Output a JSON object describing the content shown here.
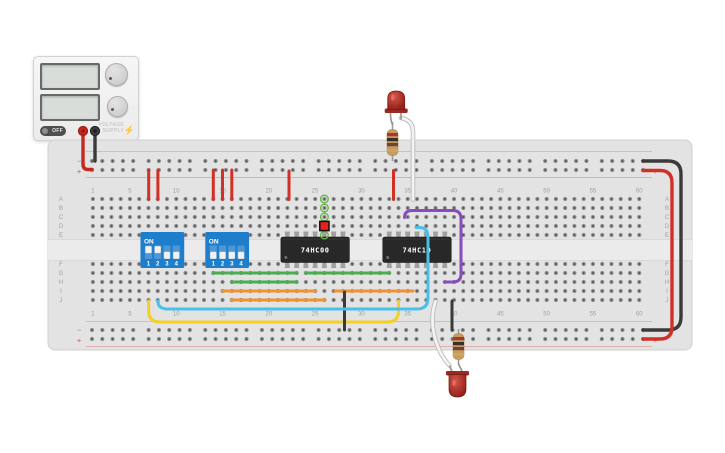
{
  "power_supply": {
    "off_label": "OFF",
    "brand_line1": "VOLTAGE",
    "brand_line2": "SUPPLY",
    "bolt_icon": "⚡",
    "terminals": [
      {
        "name": "terminal-positive",
        "cx": 83,
        "cy": 131,
        "color": "#c4281e",
        "ring": "#8f1b14"
      },
      {
        "name": "terminal-negative",
        "cx": 95,
        "cy": 131,
        "color": "#3c3c3c",
        "ring": "#1e1e1e"
      }
    ]
  },
  "breadboard": {
    "columns": 60,
    "column_labels": [
      "1",
      "5",
      "10",
      "15",
      "20",
      "25",
      "30",
      "35",
      "40",
      "45",
      "50",
      "55",
      "60"
    ],
    "row_labels_upper": [
      "A",
      "B",
      "C",
      "D",
      "E"
    ],
    "row_labels_lower": [
      "F",
      "G",
      "H",
      "I",
      "J"
    ],
    "rail_minus": "−",
    "rail_plus": "+",
    "colors": {
      "body": "#e3e3e3",
      "edge": "#cfcfcf",
      "hole": "#8f8f8f",
      "hole_core": "#484848",
      "label": "#a0a0a0",
      "blue_line": "#a9bfd9",
      "red_line": "#dba4a0"
    }
  },
  "dip_switches": [
    {
      "name": "dip-switch-a",
      "label": "ON",
      "pin_labels": [
        "1",
        "2",
        "3",
        "4"
      ],
      "states": [
        "on",
        "on",
        "off",
        "off"
      ],
      "cols": [
        7,
        8,
        9,
        10
      ]
    },
    {
      "name": "dip-switch-b",
      "label": "ON",
      "pin_labels": [
        "1",
        "2",
        "3",
        "4"
      ],
      "states": [
        "off",
        "off",
        "off",
        "off"
      ],
      "cols": [
        14,
        15,
        16,
        17
      ]
    }
  ],
  "ics": [
    {
      "name": "ic-74hc00",
      "label": "74HC00",
      "pin_count": 14,
      "col_start": 22,
      "col_end": 28
    },
    {
      "name": "ic-74hc10",
      "label": "74HC10",
      "pin_count": 14,
      "col_start": 33,
      "col_end": 39
    }
  ],
  "hover_highlight": {
    "column": 26,
    "selected_row": "D",
    "connected_rows": [
      "A",
      "B",
      "C",
      "E"
    ],
    "ring_color": "#63b93c",
    "selected_fill": "#e8211d"
  },
  "leds": [
    {
      "name": "led-top",
      "cx": 396.2,
      "flange_y": 108.5,
      "dir": "up",
      "color_hi": "#d4574a",
      "color_lo": "#8e211a"
    },
    {
      "name": "led-bottom",
      "cx": 457.5,
      "flange_y": 371,
      "dir": "down",
      "color_hi": "#d4574a",
      "color_lo": "#8e211a"
    }
  ],
  "resistors": [
    {
      "name": "resistor-top",
      "x": 392.5,
      "lead_top_y": 122,
      "body_top_y": 129.5
    },
    {
      "name": "resistor-bottom",
      "x": 458.5,
      "lead_top_y": 329,
      "body_top_y": 333.5
    }
  ],
  "resistor_style": {
    "body": "#c89a62",
    "edge": "#b08648",
    "bands": [
      "#ae352b",
      "#35302a",
      "#6e4333",
      "#c9a65c"
    ]
  },
  "wires": [
    {
      "name": "psu-positive-wire",
      "color": "#c4281e",
      "width": 3.4,
      "layer": "under",
      "path": "M83,130 L83,164 Q83,169.5 88,169.5 L92,169.5"
    },
    {
      "name": "psu-negative-wire",
      "color": "#3a3a3a",
      "width": 3.4,
      "layer": "under",
      "path": "M95,130 L95,161"
    },
    {
      "name": "rail-jumper-1",
      "color": "#d03026",
      "width": 3,
      "layer": "under",
      "path": "M148.7,170 L148.7,199.5"
    },
    {
      "name": "rail-jumper-2",
      "color": "#d03026",
      "width": 3,
      "layer": "under",
      "path": "M157.9,170 L157.9,199.5"
    },
    {
      "name": "rail-jumper-3",
      "color": "#d03026",
      "width": 3,
      "layer": "under",
      "path": "M213.3,170 L213.3,199.5"
    },
    {
      "name": "rail-jumper-4",
      "color": "#d03026",
      "width": 3,
      "layer": "under",
      "path": "M222.5,170 L222.5,199.5"
    },
    {
      "name": "rail-jumper-5",
      "color": "#d03026",
      "width": 3,
      "layer": "under",
      "path": "M231.8,170 L231.8,199.5"
    },
    {
      "name": "rail-jumper-6",
      "color": "#d03026",
      "width": 3,
      "layer": "under",
      "path": "M289,171 L289,199.5"
    },
    {
      "name": "led-top-power-wire",
      "color": "#d03026",
      "width": 3,
      "layer": "under",
      "path": "M393.5,170.5 L393.5,199.5"
    },
    {
      "name": "rail-bridge-negative",
      "color": "#3a3a3a",
      "width": 3.4,
      "layer": "under",
      "path": "M643,161 L668,161 Q681,161 681,174 L681,317 Q681,330 668,330 L643,330"
    },
    {
      "name": "rail-bridge-positive",
      "color": "#d03026",
      "width": 3.4,
      "layer": "under",
      "path": "M643,170.5 L660,170.5 Q672,170.5 672,183 L672,327 Q672,339 660,339 L643,339"
    },
    {
      "name": "green-wire-1",
      "color": "#4aae4f",
      "width": 3,
      "layer": "under",
      "path": "M213.3,273 L296.7,273"
    },
    {
      "name": "green-wire-2",
      "color": "#4aae4f",
      "width": 3,
      "layer": "under",
      "path": "M305.9,273 L389.3,273"
    },
    {
      "name": "green-wire-3",
      "color": "#4aae4f",
      "width": 3,
      "layer": "under",
      "path": "M231.8,282 L296.7,282"
    },
    {
      "name": "orange-wire-1",
      "color": "#f2912d",
      "width": 3,
      "layer": "under",
      "path": "M222.5,291 L315.1,291"
    },
    {
      "name": "orange-wire-2",
      "color": "#f2912d",
      "width": 3,
      "layer": "under",
      "path": "M335,291 L413,291"
    },
    {
      "name": "orange-wire-3",
      "color": "#f2912d",
      "width": 3,
      "layer": "under",
      "path": "M231.8,300 L324.5,300"
    },
    {
      "name": "yellow-wire",
      "color": "#f2d025",
      "width": 3,
      "layer": "under",
      "path": "M148.7,301 L148.7,311 Q148.7,322 159.7,322 L387.5,322 Q398.5,322 398.5,311 L398.5,301"
    },
    {
      "name": "mid-ground-wire",
      "color": "#3a3a3a",
      "width": 3,
      "layer": "under",
      "path": "M344.5,292 L344.5,330"
    },
    {
      "name": "bottom-ground-wire",
      "color": "#3a3a3a",
      "width": 3,
      "layer": "under",
      "path": "M452,301 L452,330"
    },
    {
      "name": "cyan-wire",
      "color": "#49c0e8",
      "width": 3,
      "layer": "over",
      "path": "M157.9,301 Q157.9,309 168,309 L417,309 Q428,309 428,298 L428,237 Q428,227.5 419.5,227.5 L416,227.5"
    },
    {
      "name": "purple-wire",
      "color": "#8a4bbf",
      "width": 3,
      "layer": "over",
      "path": "M404.5,217.5 Q404.5,210.5 412.5,210.5 L453,210.5 Q461,210.5 461,219 L461,274 Q461,282 453,282 L444.8,282"
    },
    {
      "name": "led-top-signal-wire",
      "color": "#f3f3f3",
      "width": 2.8,
      "outline": true,
      "layer": "over",
      "path": "M401,118 Q413,120 413,132 L413,199.5"
    },
    {
      "name": "led-bottom-signal-wire",
      "color": "#f3f3f3",
      "width": 2.8,
      "outline": true,
      "layer": "over",
      "path": "M435.5,301.5 Q429.5,319 435.5,340 Q440.5,356 449.5,365.5"
    }
  ],
  "ic_style": {
    "body": "#282828",
    "pin": "#a0a0a0",
    "label_color": "#ffffff"
  },
  "dip_style": {
    "body": "#1f7ecc",
    "well": "#4e96d4",
    "slider": "#f2f2f2",
    "text": "#ffffff"
  }
}
